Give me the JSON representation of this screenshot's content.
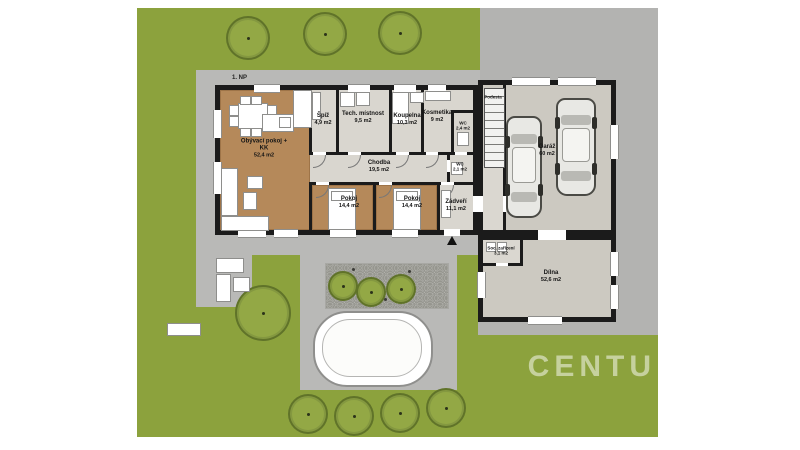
{
  "plan": {
    "floor_label": "1. NP",
    "watermark": "CENTU",
    "rooms": [
      {
        "name": "Obývací pokoj + KK",
        "area": "52,4 m2"
      },
      {
        "name": "Špíž",
        "area": "4,9 m2"
      },
      {
        "name": "Tech. místnost",
        "area": "9,5 m2"
      },
      {
        "name": "Koupelna",
        "area": "10,3 m2"
      },
      {
        "name": "Kosmetika",
        "area": "9 m2"
      },
      {
        "name": "WC",
        "area": "2,4 m2"
      },
      {
        "name": "Chodba",
        "area": "19,5 m2"
      },
      {
        "name": "WC",
        "area": "2,1 m2"
      },
      {
        "name": "Pokoj",
        "area": "14,4 m2"
      },
      {
        "name": "Pokoj",
        "area": "14,4 m2"
      },
      {
        "name": "Zádveří",
        "area": "11,1 m2"
      },
      {
        "name": "Podesta",
        "area": ""
      },
      {
        "name": "Garáž",
        "area": "60 m2"
      },
      {
        "name": "Soc. zařízení",
        "area": "3,1 m2"
      },
      {
        "name": "Dílna",
        "area": "52,6 m2"
      }
    ],
    "colors": {
      "garden_green": "#8ca23d",
      "driveway_gray": "#b3b3b1",
      "paving_gray": "#b9b9b7",
      "wall_black": "#1b1b1b",
      "wood_floor": "#b5895a",
      "room_floor": "#dad7d0",
      "garage_floor": "#ccc9c1",
      "pool_white": "#ffffff"
    }
  }
}
